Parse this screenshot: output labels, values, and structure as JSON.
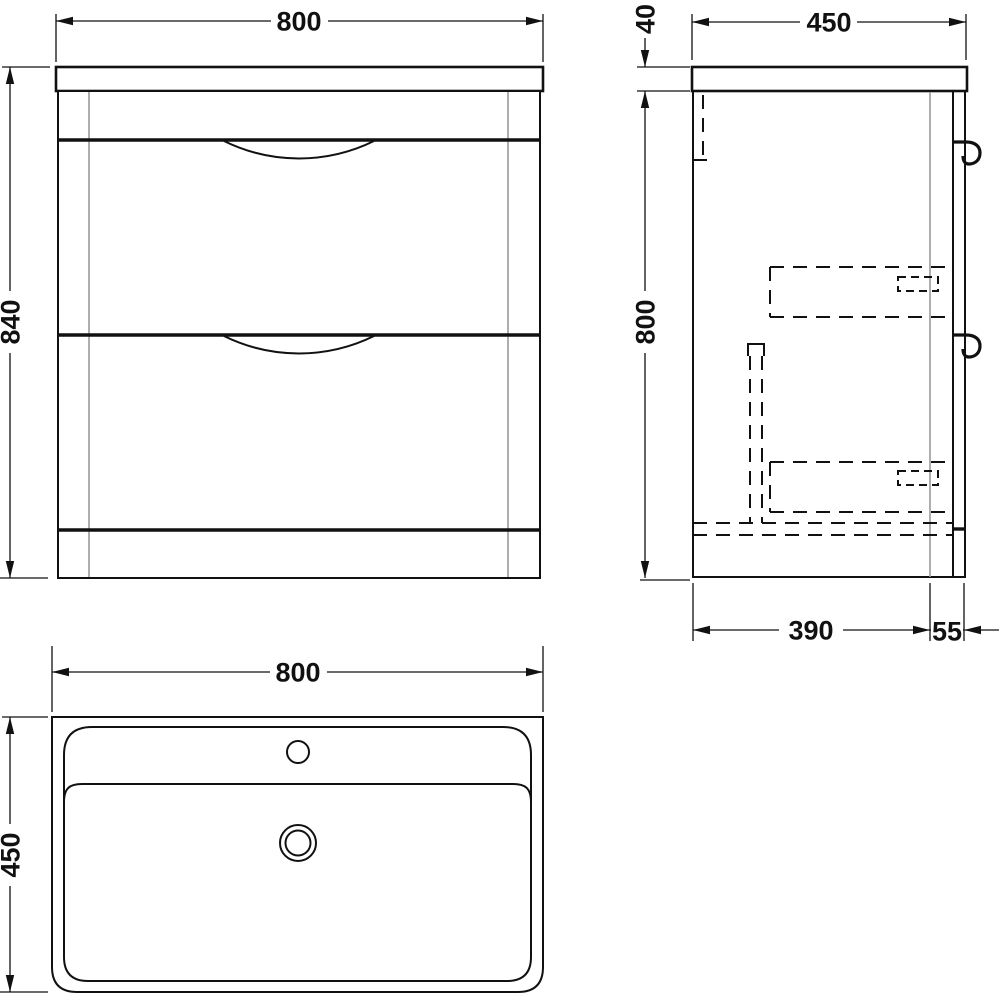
{
  "diagram": {
    "front_view": {
      "width": "800",
      "height": "840"
    },
    "side_view": {
      "countertop_thickness": "40",
      "depth": "450",
      "carcass_height": "800",
      "base_depth": "390",
      "front_offset": "55"
    },
    "basin_view": {
      "width": "800",
      "depth": "450"
    },
    "colors": {
      "line": "#111111",
      "panel_line": "#9a9a9a",
      "background": "#ffffff"
    }
  }
}
